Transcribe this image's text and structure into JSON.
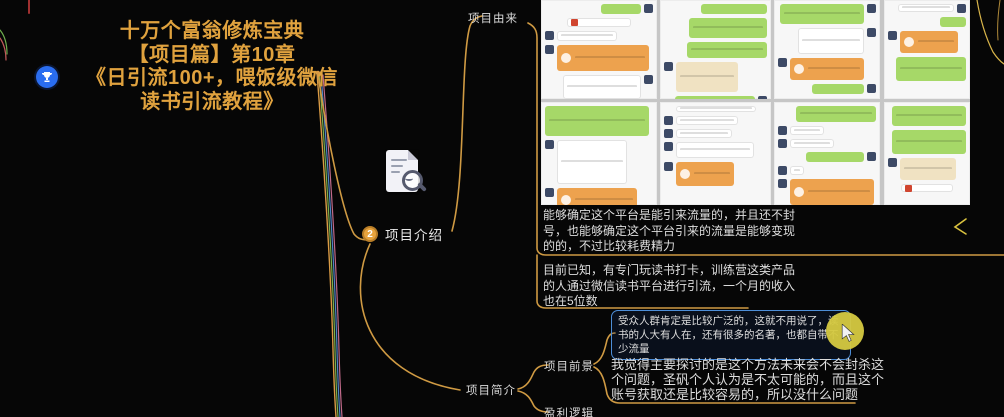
{
  "root_title": {
    "lines": [
      "十万个富翁修炼宝典",
      "【项目篇】第10章",
      "《日引流100+，喂饭级微信",
      "读书引流教程》"
    ]
  },
  "nodes": {
    "intro": {
      "num": "2",
      "label": "项目介绍"
    },
    "origin": {
      "label": "项目由来"
    },
    "brief": {
      "label": "项目简介"
    },
    "prospect": {
      "label": "项目前景"
    },
    "profit": {
      "label": "盈利逻辑"
    }
  },
  "notes": {
    "note1": "能够确定这个平台是能引来流量的，并且还不封号，也能够确定这个平台引来的流量是能够变现的的，不过比较耗费精力",
    "note2": "目前已知，有专门玩读书打卡，训练营这类产品的人通过微信读书平台进行引流，一个月的收入也在5位数",
    "note3": "受众人群肯定是比较广泛的，这就不用说了，读书的人大有人在，还有很多的名著，也都自带不少流量",
    "note4": "我觉得主要探讨的是这个方法未来会不会封杀这个问题，圣矾个人认为是不太可能的，而且这个账号获取还是比较容易的，所以没什么问题"
  },
  "icons": {
    "trophy": "trophy-marker",
    "document_search": "document-with-magnifier-sticker",
    "cursor": "mouse-cursor-highlight"
  },
  "colors": {
    "background": "#060606",
    "title_orange": "#e0a23e",
    "edge_orange": "#cf9a43",
    "highlight_border_blue": "#4d8ed8",
    "cursor_yellow": "#d6ca41",
    "bubble_green": "#a6d868",
    "bubble_orange": "#eda24e",
    "bubble_cream": "#f0e2c2",
    "trophy_blue": "#2a6df0"
  },
  "collage": {
    "panels": [
      {
        "x": 0,
        "y": 0,
        "w": 116,
        "h": 99,
        "bubbles": [
          [
            "r",
            "g",
            40,
            10,
            1
          ],
          [
            "c",
            "link",
            64,
            9,
            0
          ],
          [
            "l",
            "w",
            60,
            10,
            1
          ],
          [
            "l",
            "o",
            92,
            26,
            1
          ],
          [
            "r",
            "w",
            78,
            24,
            1
          ]
        ]
      },
      {
        "x": 119,
        "y": 0,
        "w": 111,
        "h": 99,
        "bubbles": [
          [
            "r",
            "g",
            66,
            10,
            0
          ],
          [
            "r",
            "g",
            78,
            20,
            0
          ],
          [
            "r",
            "g",
            80,
            16,
            0
          ],
          [
            "l",
            "c",
            62,
            30,
            1
          ],
          [
            "r",
            "g",
            80,
            20,
            1
          ]
        ]
      },
      {
        "x": 233,
        "y": 0,
        "w": 106,
        "h": 99,
        "bubbles": [
          [
            "r",
            "g",
            84,
            20,
            1
          ],
          [
            "r",
            "w",
            66,
            26,
            1
          ],
          [
            "l",
            "o",
            74,
            22,
            1
          ],
          [
            "r",
            "g",
            52,
            10,
            1
          ]
        ]
      },
      {
        "x": 343,
        "y": 0,
        "w": 86,
        "h": 99,
        "bubbles": [
          [
            "r",
            "w",
            56,
            8,
            1
          ],
          [
            "r",
            "g",
            26,
            10,
            0
          ],
          [
            "l",
            "o",
            58,
            22,
            1
          ],
          [
            "r",
            "g",
            70,
            24,
            0
          ]
        ]
      },
      {
        "x": 0,
        "y": 102,
        "w": 116,
        "h": 103,
        "bubbles": [
          [
            "l",
            "g",
            104,
            30,
            0
          ],
          [
            "l",
            "w",
            70,
            44,
            1
          ],
          [
            "l",
            "o",
            80,
            24,
            1
          ]
        ]
      },
      {
        "x": 119,
        "y": 102,
        "w": 111,
        "h": 103,
        "bubbles": [
          [
            "c",
            "w",
            80,
            6,
            0
          ],
          [
            "l",
            "w",
            62,
            9,
            1
          ],
          [
            "l",
            "w",
            56,
            9,
            1
          ],
          [
            "l",
            "w",
            78,
            16,
            1
          ],
          [
            "l",
            "o",
            58,
            24,
            1
          ]
        ]
      },
      {
        "x": 233,
        "y": 102,
        "w": 106,
        "h": 103,
        "bubbles": [
          [
            "r",
            "g",
            80,
            16,
            0
          ],
          [
            "l",
            "w",
            34,
            9,
            1
          ],
          [
            "l",
            "w",
            44,
            9,
            1
          ],
          [
            "r",
            "g",
            58,
            10,
            1
          ],
          [
            "l",
            "w",
            14,
            9,
            1
          ],
          [
            "l",
            "o",
            84,
            26,
            1
          ]
        ]
      },
      {
        "x": 343,
        "y": 102,
        "w": 86,
        "h": 103,
        "bubbles": [
          [
            "r",
            "g",
            74,
            20,
            0
          ],
          [
            "r",
            "g",
            74,
            24,
            0
          ],
          [
            "l",
            "c",
            56,
            22,
            1
          ],
          [
            "c",
            "link",
            52,
            8,
            0
          ]
        ]
      }
    ]
  }
}
